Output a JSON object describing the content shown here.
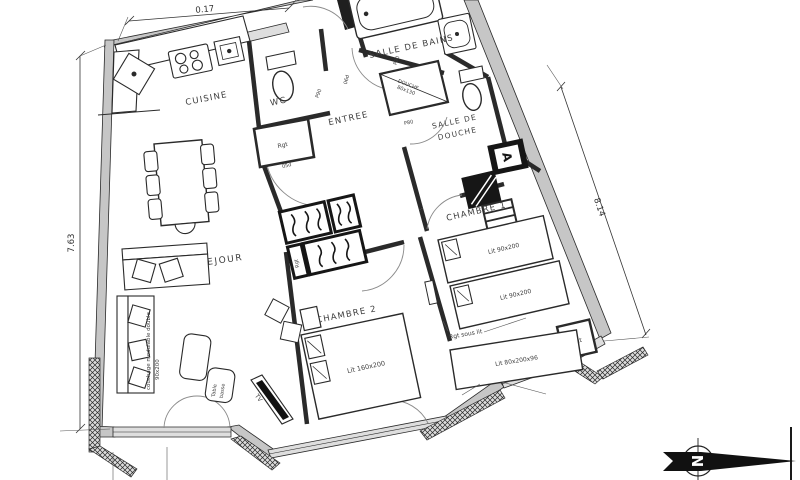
{
  "plan_type": "apartment-floor-plan",
  "dims": {
    "top": "0.17",
    "left": "7.63",
    "right": "8.14"
  },
  "rooms": {
    "cuisine": "CUISINE",
    "wc": "WC",
    "entree": "ENTREE",
    "salle_de_bains": "SALLE DE BAINS",
    "sdd1": "SALLE DE",
    "sdd2": "DOUCHE",
    "chambre1": "CHAMBRE 1",
    "chambre2": "CHAMBRE 2",
    "sejour": "SEJOUR"
  },
  "furn": {
    "bed1": "Lit 90x200",
    "bed2": "Lit 90x200",
    "bed_double": "Lit 160x200",
    "bed_bench": "Lit 80x200x96",
    "rgt_sous_lit": "Rgt sous lit",
    "rgt_wc": "Rgt",
    "rgt_wardrobe": "Rgt",
    "rgt_ch1": "Rgt",
    "shower1": "DOUCHE",
    "shower2": "80x130",
    "table1": "Table",
    "table2": "basse",
    "tv": "TV",
    "couch1": "couchage modulable double",
    "couch2": "90x200"
  },
  "doors": {
    "p90": "P90",
    "p80": "P80",
    "wc_door": "P90",
    "d05": "05d",
    "d06": "06d"
  },
  "shaft": {
    "label": "A"
  },
  "compass": {
    "north": "N"
  },
  "colors": {
    "wall_fill": "#c6c6c6",
    "window_fill": "#dedede",
    "line": "#2a2a2a",
    "text": "#3d3d3d"
  }
}
